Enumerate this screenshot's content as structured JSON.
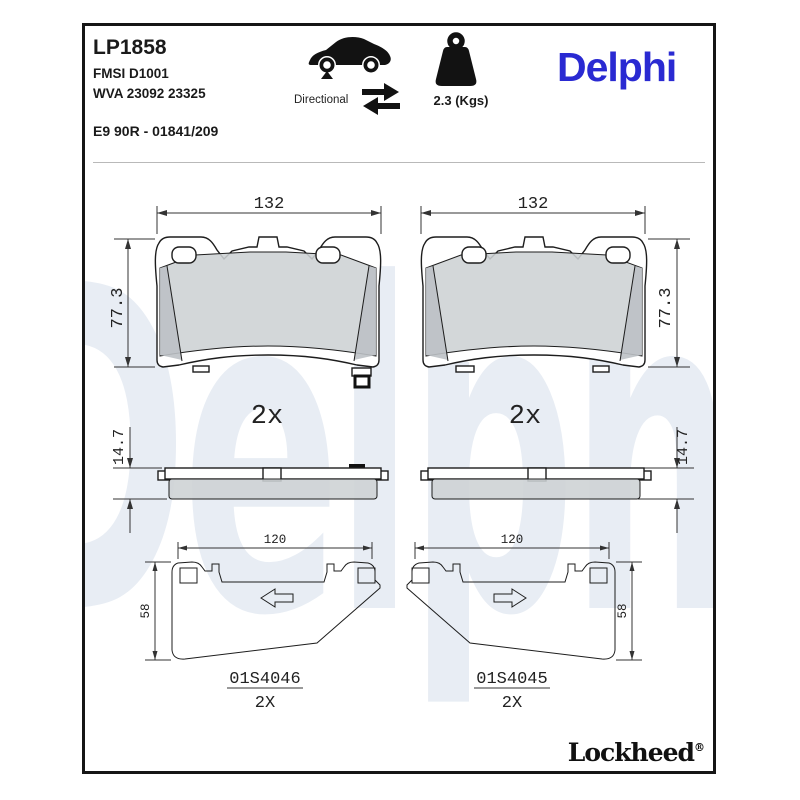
{
  "header": {
    "part_number": "LP1858",
    "fmsi": "FMSI D1001",
    "wva": "WVA 23092 23325",
    "approval": "E9 90R - 01841/209",
    "directional_label": "Directional",
    "weight_label": "2.3 (Kgs)",
    "brand": "Delphi"
  },
  "watermark": "Delphi",
  "drawings": {
    "pad_front_left": {
      "width_dim": "132",
      "height_dim": "77.3"
    },
    "pad_front_right": {
      "width_dim": "132",
      "height_dim": "77.3"
    },
    "side_left": {
      "qty": "2x",
      "thickness_dim": "14.7"
    },
    "side_right": {
      "qty": "2x",
      "thickness_dim": "14.7"
    },
    "shim_left": {
      "width_dim": "120",
      "height_dim": "58",
      "part": "01S4046",
      "qty": "2X"
    },
    "shim_right": {
      "width_dim": "120",
      "height_dim": "58",
      "part": "01S4045",
      "qty": "2X"
    }
  },
  "footer": {
    "brand": "Lockheed",
    "registered": "®"
  },
  "colors": {
    "brand_blue": "#2a2ad2",
    "watermark_blue": "#e8edf4",
    "friction_grey": "#cdd1d4"
  }
}
